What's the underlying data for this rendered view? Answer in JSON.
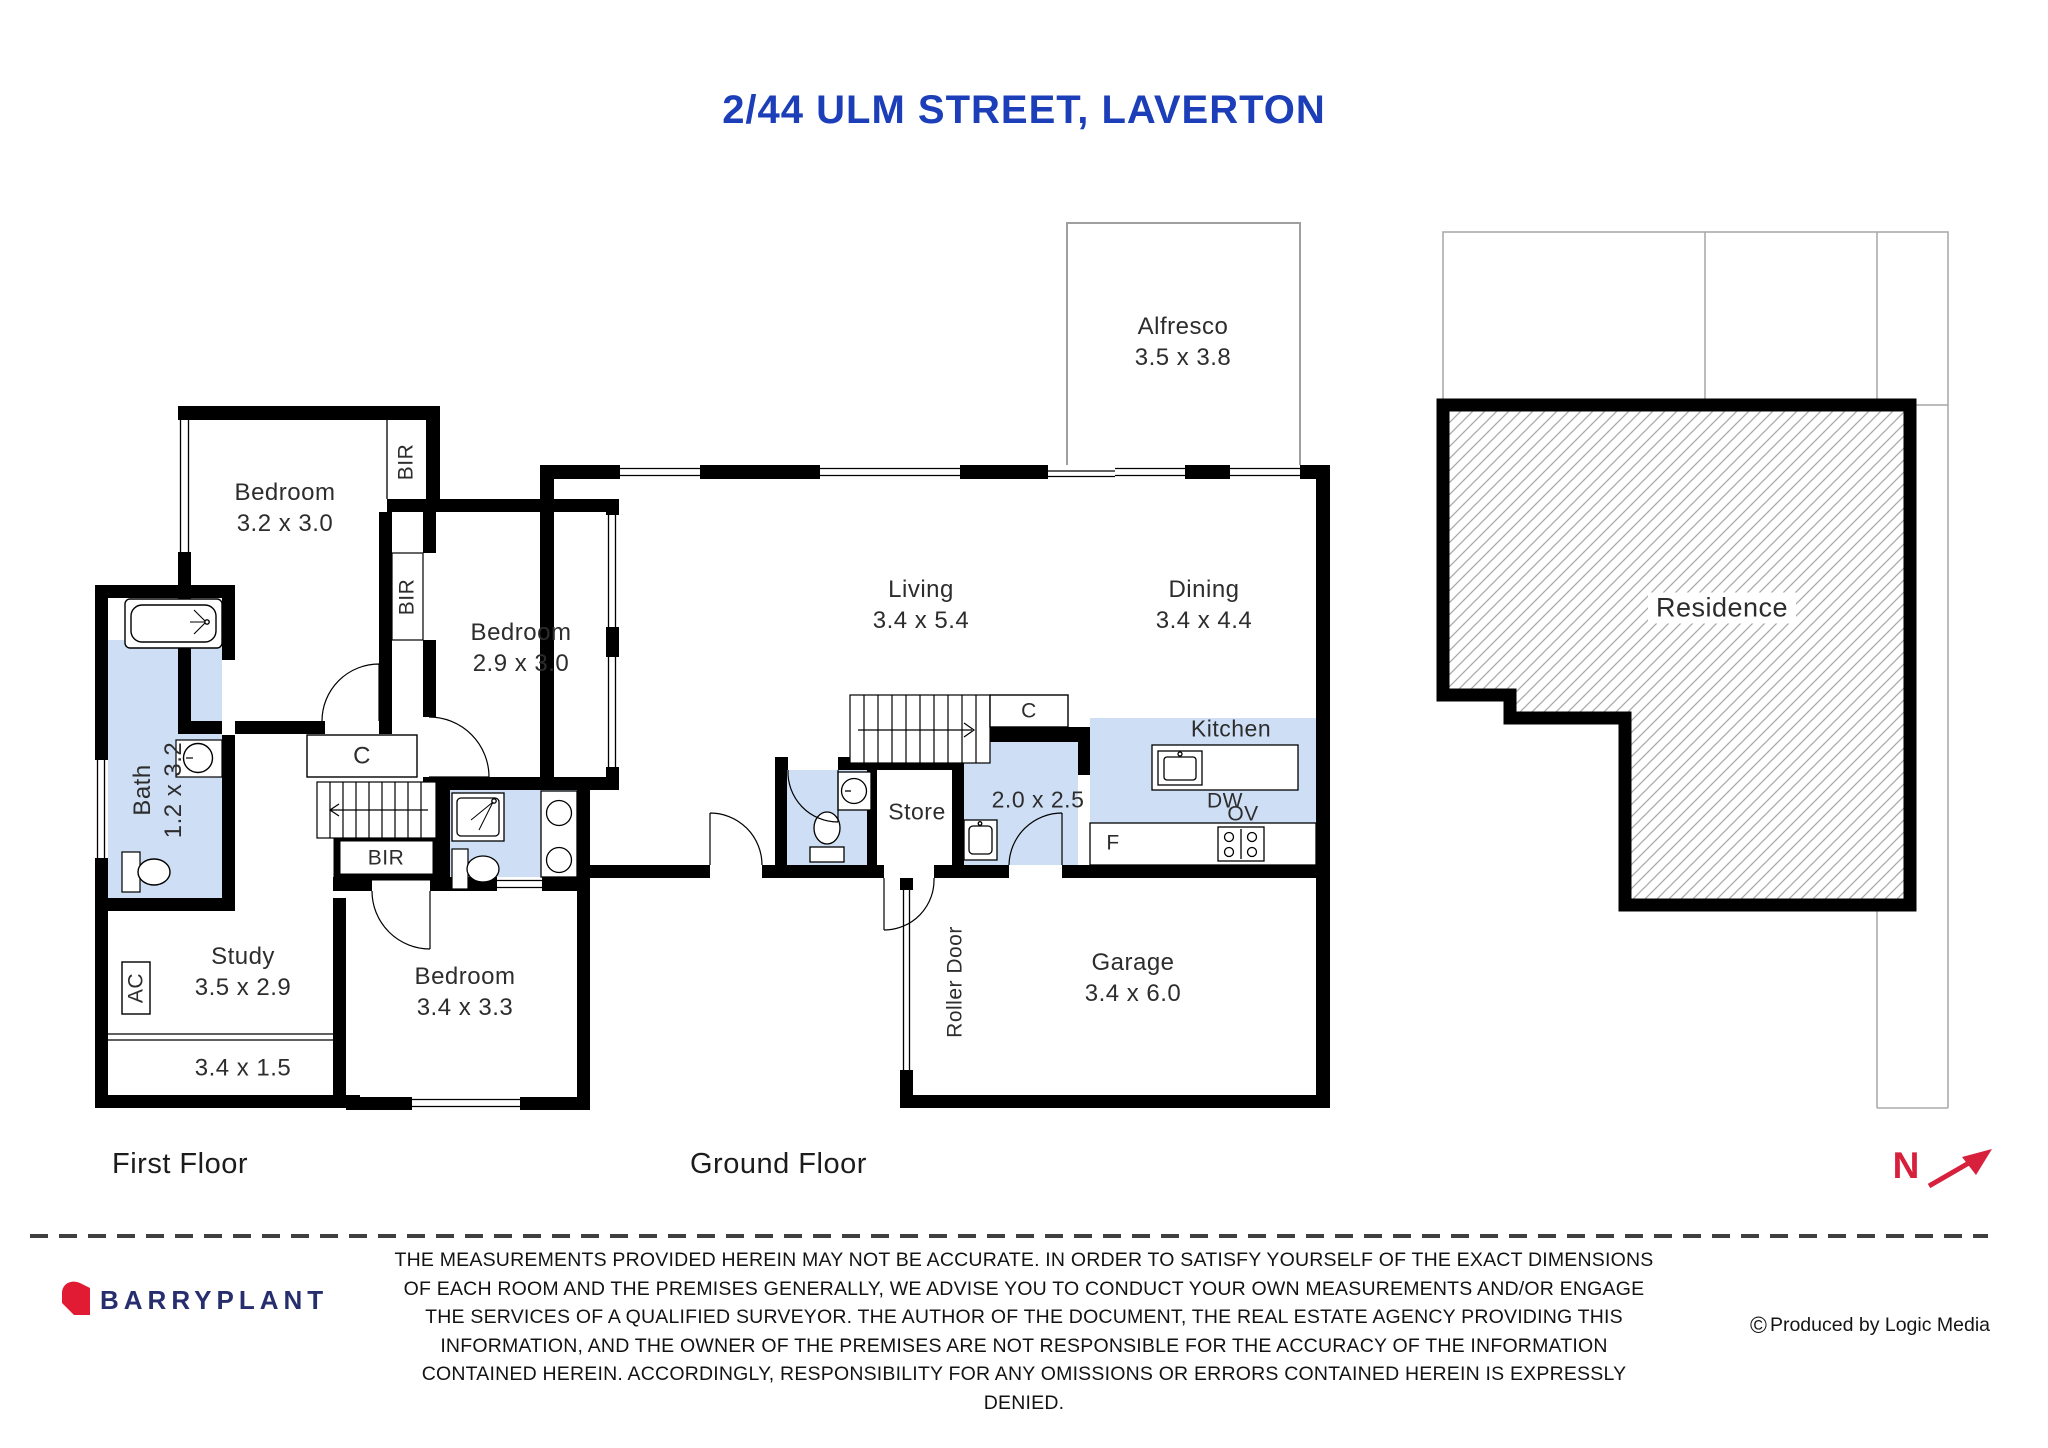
{
  "title": "2/44 ULM STREET, LAVERTON",
  "first_floor": {
    "label": "First Floor",
    "bedroom1": {
      "name": "Bedroom",
      "dims": "3.2 x 3.0"
    },
    "bedroom2": {
      "name": "Bedroom",
      "dims": "2.9 x 3.0"
    },
    "bedroom3": {
      "name": "Bedroom",
      "dims": "3.4 x 3.3"
    },
    "bath": {
      "name": "Bath",
      "dims": "1.2 x 3.2"
    },
    "study": {
      "name": "Study",
      "dims": "3.5 x 2.9"
    },
    "landing_area": {
      "dims": "3.4 x 1.5"
    },
    "bir_bedroom1": "BIR",
    "bir_bedroom2": "BIR",
    "bir_bedroom3": "BIR",
    "closet": "C",
    "air_conditioner": "AC"
  },
  "ground_floor": {
    "label": "Ground Floor",
    "alfresco": {
      "name": "Alfresco",
      "dims": "3.5 x 3.8"
    },
    "living": {
      "name": "Living",
      "dims": "3.4 x 5.4"
    },
    "dining": {
      "name": "Dining",
      "dims": "3.4 x 4.4"
    },
    "kitchen": {
      "name": "Kitchen"
    },
    "laundry": {
      "dims": "2.0 x 2.5"
    },
    "store": {
      "name": "Store"
    },
    "garage": {
      "name": "Garage",
      "dims": "3.4 x 6.0"
    },
    "roller_door": "Roller Door",
    "closet": "C",
    "dishwasher": "DW",
    "oven": "OV",
    "fridge": "F"
  },
  "site_plan": {
    "residence": "Residence"
  },
  "compass": {
    "north": "N"
  },
  "footer": {
    "brand": "BARRYPLANT",
    "credit_symbol": "©",
    "credit": "Produced by Logic Media",
    "disclaimer_lines": [
      "THE MEASUREMENTS PROVIDED HEREIN MAY NOT BE ACCURATE. IN ORDER TO SATISFY YOURSELF OF THE EXACT DIMENSIONS",
      "OF EACH ROOM AND THE PREMISES GENERALLY, WE ADVISE YOU TO CONDUCT YOUR OWN MEASUREMENTS AND/OR ENGAGE",
      "THE SERVICES OF A QUALIFIED SURVEYOR. THE AUTHOR OF THE DOCUMENT, THE REAL ESTATE AGENCY PROVIDING THIS",
      "INFORMATION, AND THE OWNER OF THE PREMISES ARE NOT RESPONSIBLE FOR THE ACCURACY OF THE INFORMATION",
      "CONTAINED HEREIN. ACCORDINGLY, RESPONSIBILITY FOR ANY OMISSIONS OR ERRORS CONTAINED HEREIN IS EXPRESSLY",
      "DENIED."
    ]
  },
  "colors": {
    "title": "#1c3eb8",
    "wet_area": "#cedef5",
    "wall": "#000000",
    "brand_text": "#262e6e",
    "brand_mark": "#e11b33",
    "north": "#d6203c",
    "site_line": "#ababab"
  }
}
